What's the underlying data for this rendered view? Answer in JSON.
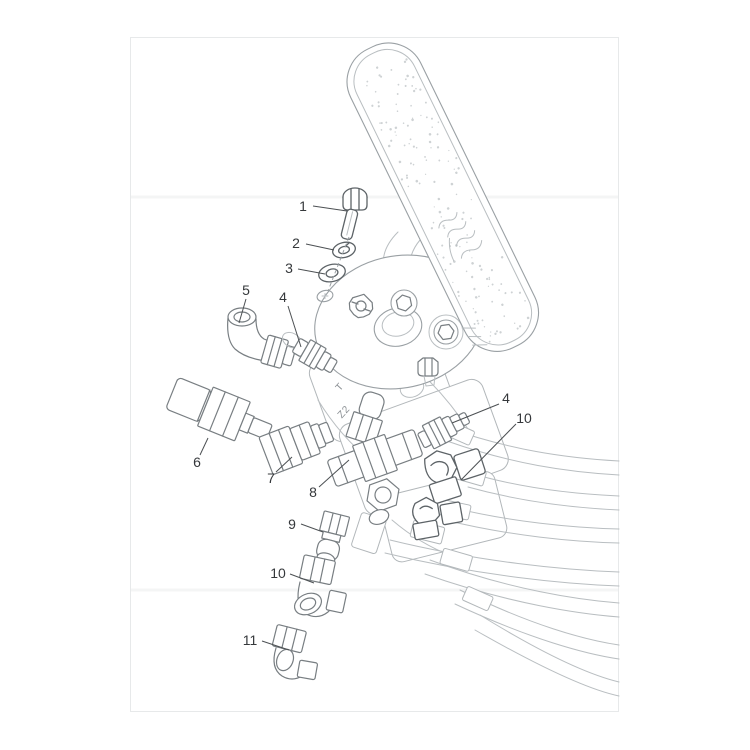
{
  "page": {
    "background": "#ffffff"
  },
  "diagram": {
    "type": "exploded-parts-diagram",
    "subject": "Foot pedal control valve with mounting bolt, washers, hydraulic fittings and hose bundle",
    "callouts": [
      {
        "label": "1",
        "x": 303,
        "y": 211,
        "leader": [
          313,
          206,
          347,
          211
        ]
      },
      {
        "label": "2",
        "x": 296,
        "y": 248,
        "leader": [
          306,
          244,
          334,
          250
        ]
      },
      {
        "label": "3",
        "x": 289,
        "y": 273,
        "leader": [
          298,
          269,
          325,
          274
        ]
      },
      {
        "label": "5",
        "x": 246,
        "y": 295,
        "leader": [
          246,
          299,
          239,
          323
        ]
      },
      {
        "label": "4",
        "x": 283,
        "y": 302,
        "leader": [
          288,
          306,
          301,
          347
        ]
      },
      {
        "label": "6",
        "x": 197,
        "y": 467,
        "leader": [
          200,
          455,
          208,
          438
        ]
      },
      {
        "label": "7",
        "x": 271,
        "y": 483,
        "leader": [
          276,
          472,
          292,
          457
        ]
      },
      {
        "label": "8",
        "x": 313,
        "y": 497,
        "leader": [
          319,
          487,
          349,
          460
        ]
      },
      {
        "label": "9",
        "x": 292,
        "y": 529,
        "leader": [
          301,
          524,
          323,
          532
        ]
      },
      {
        "label": "10",
        "x": 278,
        "y": 578,
        "leader": [
          290,
          574,
          314,
          583
        ]
      },
      {
        "label": "11",
        "x": 250,
        "y": 645,
        "leader": [
          262,
          641,
          289,
          650
        ]
      },
      {
        "label": "4",
        "x": 506,
        "y": 403,
        "leader": [
          499,
          404,
          452,
          423
        ]
      },
      {
        "label": "10",
        "x": 524,
        "y": 423,
        "leader": [
          516,
          424,
          461,
          480
        ]
      }
    ],
    "valve_port_markings": [
      {
        "text": "T",
        "x": 342,
        "y": 389,
        "rotate": -48
      },
      {
        "text": "Z2",
        "x": 346,
        "y": 414,
        "rotate": -48
      }
    ],
    "colors": {
      "part_outline": "#9aa0a4",
      "fitting_outline": "#787e82",
      "dark_fitting_outline": "#5d6367",
      "hose_line": "#b9bec1",
      "leader_line": "#4c5053",
      "label_text": "#35383b",
      "page_frame": "#e7e9ea"
    }
  }
}
